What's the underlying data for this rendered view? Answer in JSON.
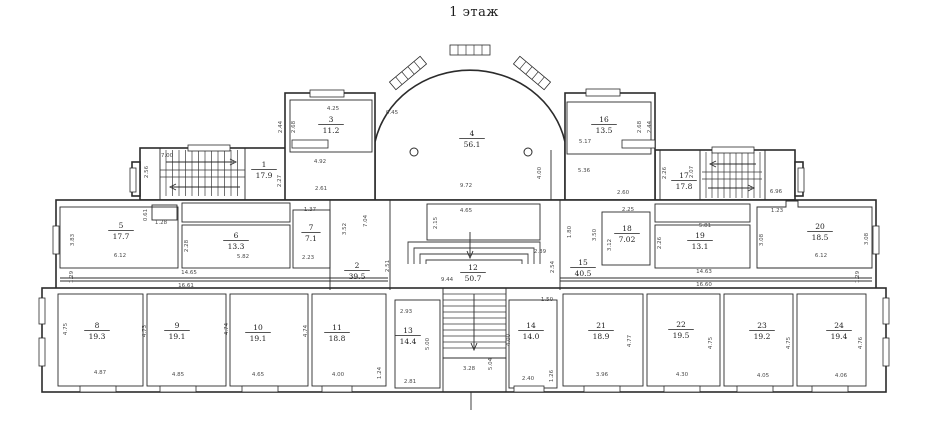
{
  "title": "1 этаж",
  "style": {
    "wall_color": "#2b2b2b",
    "background": "#ffffff",
    "label_color": "#1c1c1c"
  },
  "rooms": [
    {
      "num": "1",
      "area": "17.9",
      "x": 264,
      "y": 167
    },
    {
      "num": "2",
      "area": "39.5",
      "x": 357,
      "y": 268
    },
    {
      "num": "3",
      "area": "11.2",
      "x": 331,
      "y": 122
    },
    {
      "num": "4",
      "area": "56.1",
      "x": 472,
      "y": 136
    },
    {
      "num": "5",
      "area": "17.7",
      "x": 121,
      "y": 228
    },
    {
      "num": "6",
      "area": "13.3",
      "x": 236,
      "y": 238
    },
    {
      "num": "7",
      "area": "7.1",
      "x": 311,
      "y": 230
    },
    {
      "num": "8",
      "area": "19.3",
      "x": 97,
      "y": 328
    },
    {
      "num": "9",
      "area": "19.1",
      "x": 177,
      "y": 328
    },
    {
      "num": "10",
      "area": "19.1",
      "x": 258,
      "y": 330
    },
    {
      "num": "11",
      "area": "18.8",
      "x": 337,
      "y": 330
    },
    {
      "num": "12",
      "area": "50.7",
      "x": 473,
      "y": 270
    },
    {
      "num": "13",
      "area": "14.4",
      "x": 408,
      "y": 333
    },
    {
      "num": "14",
      "area": "14.0",
      "x": 531,
      "y": 328
    },
    {
      "num": "15",
      "area": "40.5",
      "x": 583,
      "y": 265
    },
    {
      "num": "16",
      "area": "13.5",
      "x": 604,
      "y": 122
    },
    {
      "num": "17",
      "area": "17.8",
      "x": 684,
      "y": 178
    },
    {
      "num": "18",
      "area": "7.02",
      "x": 627,
      "y": 231
    },
    {
      "num": "19",
      "area": "13.1",
      "x": 700,
      "y": 238
    },
    {
      "num": "20",
      "area": "18.5",
      "x": 820,
      "y": 229
    },
    {
      "num": "21",
      "area": "18.9",
      "x": 601,
      "y": 328
    },
    {
      "num": "22",
      "area": "19.5",
      "x": 681,
      "y": 327
    },
    {
      "num": "23",
      "area": "19.2",
      "x": 762,
      "y": 328
    },
    {
      "num": "24",
      "area": "19.4",
      "x": 839,
      "y": 328
    }
  ],
  "dimensions": [
    {
      "t": "7.00",
      "x": 167,
      "y": 157
    },
    {
      "t": "2.56",
      "x": 148,
      "y": 172,
      "v": 1
    },
    {
      "t": "4.92",
      "x": 320,
      "y": 163
    },
    {
      "t": "2.27",
      "x": 281,
      "y": 181,
      "v": 1
    },
    {
      "t": "2.61",
      "x": 321,
      "y": 190
    },
    {
      "t": "4.25",
      "x": 333,
      "y": 110
    },
    {
      "t": "2.68",
      "x": 295,
      "y": 127,
      "v": 1
    },
    {
      "t": "2.44",
      "x": 282,
      "y": 127,
      "v": 1
    },
    {
      "t": "0.45",
      "x": 392,
      "y": 114
    },
    {
      "t": "9.72",
      "x": 466,
      "y": 187
    },
    {
      "t": "4.00",
      "x": 541,
      "y": 173,
      "v": 1
    },
    {
      "t": "5.17",
      "x": 585,
      "y": 143
    },
    {
      "t": "5.36",
      "x": 584,
      "y": 172
    },
    {
      "t": "2.60",
      "x": 623,
      "y": 194
    },
    {
      "t": "2.68",
      "x": 641,
      "y": 127,
      "v": 1
    },
    {
      "t": "2.44",
      "x": 651,
      "y": 127,
      "v": 1
    },
    {
      "t": "2.26",
      "x": 666,
      "y": 173,
      "v": 1
    },
    {
      "t": "2.07",
      "x": 693,
      "y": 172,
      "v": 1
    },
    {
      "t": "6.96",
      "x": 776,
      "y": 193
    },
    {
      "t": "1.23",
      "x": 777,
      "y": 212
    },
    {
      "t": "0.61",
      "x": 147,
      "y": 215,
      "v": 1
    },
    {
      "t": "1.28",
      "x": 161,
      "y": 224
    },
    {
      "t": "3.83",
      "x": 74,
      "y": 240,
      "v": 1
    },
    {
      "t": "6.12",
      "x": 120,
      "y": 257
    },
    {
      "t": "2.28",
      "x": 188,
      "y": 246,
      "v": 1
    },
    {
      "t": "5.82",
      "x": 243,
      "y": 258
    },
    {
      "t": "1.37",
      "x": 310,
      "y": 211
    },
    {
      "t": "2.23",
      "x": 308,
      "y": 259
    },
    {
      "t": "3.52",
      "x": 346,
      "y": 229,
      "v": 1
    },
    {
      "t": "7.04",
      "x": 367,
      "y": 221,
      "v": 1
    },
    {
      "t": "2.15",
      "x": 437,
      "y": 223,
      "v": 1
    },
    {
      "t": "4.65",
      "x": 466,
      "y": 212
    },
    {
      "t": "2.51",
      "x": 389,
      "y": 266,
      "v": 1
    },
    {
      "t": "9.44",
      "x": 447,
      "y": 281
    },
    {
      "t": "2.39",
      "x": 540,
      "y": 253
    },
    {
      "t": "2.54",
      "x": 554,
      "y": 267,
      "v": 1
    },
    {
      "t": "1.80",
      "x": 571,
      "y": 232,
      "v": 1
    },
    {
      "t": "3.50",
      "x": 596,
      "y": 235,
      "v": 1
    },
    {
      "t": "2.25",
      "x": 628,
      "y": 211
    },
    {
      "t": "3.12",
      "x": 611,
      "y": 245,
      "v": 1
    },
    {
      "t": "5.81",
      "x": 705,
      "y": 227
    },
    {
      "t": "2.26",
      "x": 661,
      "y": 243,
      "v": 1
    },
    {
      "t": "14.65",
      "x": 189,
      "y": 274
    },
    {
      "t": "16.61",
      "x": 186,
      "y": 287
    },
    {
      "t": "1.29",
      "x": 73,
      "y": 277,
      "v": 1
    },
    {
      "t": "14.63",
      "x": 704,
      "y": 273
    },
    {
      "t": "16.60",
      "x": 704,
      "y": 286
    },
    {
      "t": "1.29",
      "x": 859,
      "y": 277,
      "v": 1
    },
    {
      "t": "3.08",
      "x": 763,
      "y": 240,
      "v": 1
    },
    {
      "t": "3.08",
      "x": 868,
      "y": 239,
      "v": 1
    },
    {
      "t": "6.12",
      "x": 821,
      "y": 257
    },
    {
      "t": "4.75",
      "x": 67,
      "y": 329,
      "v": 1
    },
    {
      "t": "4.87",
      "x": 100,
      "y": 374
    },
    {
      "t": "4.73",
      "x": 146,
      "y": 331,
      "v": 1
    },
    {
      "t": "4.85",
      "x": 178,
      "y": 376
    },
    {
      "t": "4.74",
      "x": 228,
      "y": 329,
      "v": 1
    },
    {
      "t": "4.65",
      "x": 258,
      "y": 376
    },
    {
      "t": "4.74",
      "x": 307,
      "y": 331,
      "v": 1
    },
    {
      "t": "4.00",
      "x": 338,
      "y": 376
    },
    {
      "t": "1.24",
      "x": 381,
      "y": 373,
      "v": 1
    },
    {
      "t": "2.93",
      "x": 406,
      "y": 313
    },
    {
      "t": "5.00",
      "x": 429,
      "y": 344,
      "v": 1
    },
    {
      "t": "2.81",
      "x": 410,
      "y": 383
    },
    {
      "t": "3.28",
      "x": 469,
      "y": 370
    },
    {
      "t": "5.04",
      "x": 492,
      "y": 364,
      "v": 1
    },
    {
      "t": "1.50",
      "x": 547,
      "y": 301
    },
    {
      "t": "4.00",
      "x": 510,
      "y": 340,
      "v": 1
    },
    {
      "t": "2.40",
      "x": 528,
      "y": 380
    },
    {
      "t": "1.26",
      "x": 553,
      "y": 376,
      "v": 1
    },
    {
      "t": "4.77",
      "x": 631,
      "y": 341,
      "v": 1
    },
    {
      "t": "3.96",
      "x": 602,
      "y": 376
    },
    {
      "t": "4.75",
      "x": 712,
      "y": 343,
      "v": 1
    },
    {
      "t": "4.30",
      "x": 682,
      "y": 376
    },
    {
      "t": "4.75",
      "x": 790,
      "y": 343,
      "v": 1
    },
    {
      "t": "4.05",
      "x": 763,
      "y": 377
    },
    {
      "t": "4.76",
      "x": 862,
      "y": 343,
      "v": 1
    },
    {
      "t": "4.06",
      "x": 841,
      "y": 377
    }
  ]
}
